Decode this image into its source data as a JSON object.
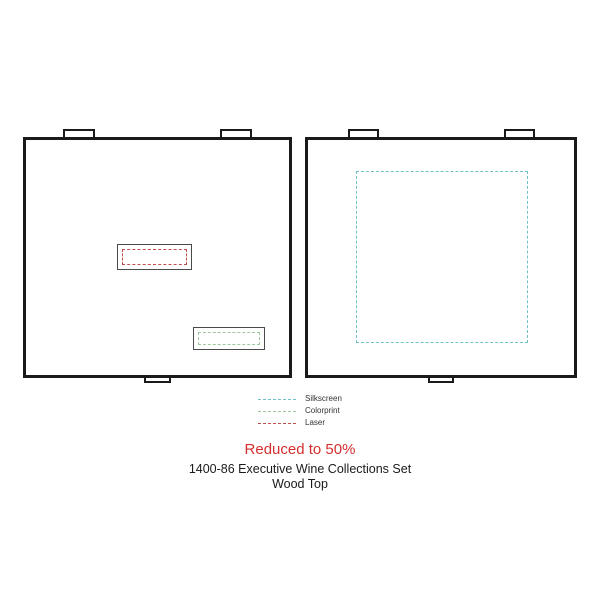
{
  "canvas": {
    "background": "#ffffff",
    "line_color": "#1a1a1a"
  },
  "panels": {
    "left": {
      "imprint_areas": [
        {
          "method": "Laser",
          "color": "#c0504d"
        },
        {
          "method": "Colorprint",
          "color": "#9dc89d"
        }
      ]
    },
    "right": {
      "imprint_areas": [
        {
          "method": "Silkscreen",
          "color": "#6fc0c7"
        }
      ]
    }
  },
  "legend": {
    "items": [
      {
        "label": "Silkscreen",
        "color": "#6fc0c7"
      },
      {
        "label": "Colorprint",
        "color": "#9dc89d"
      },
      {
        "label": "Laser",
        "color": "#c0504d"
      }
    ]
  },
  "footer": {
    "reduction_notice": "Reduced to 50%",
    "notice_color": "#d42f2f",
    "product_title": "1400-86 Executive Wine Collections Set",
    "product_subtitle": "Wood Top"
  }
}
